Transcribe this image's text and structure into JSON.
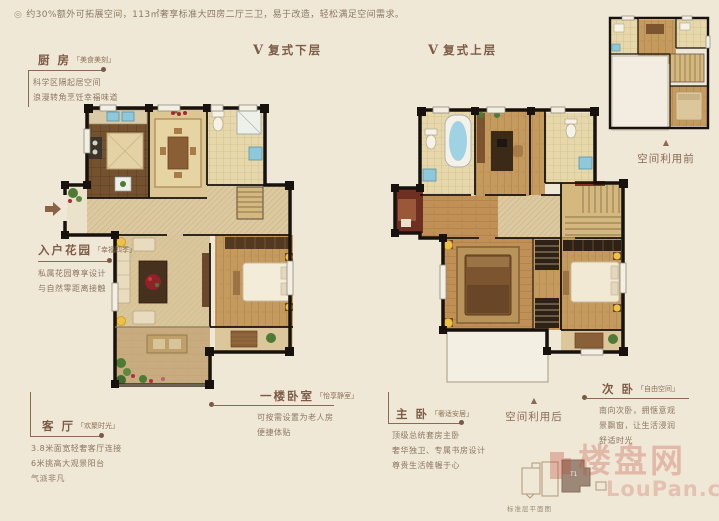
{
  "page": {
    "bullet": "◎",
    "header_note": "约30%额外可拓展空间，113㎡奢享标准大四房二厅三卫，易于改造，轻松满足空间需求。"
  },
  "sections": {
    "lower": {
      "marker": "V",
      "title": "复式下层"
    },
    "upper": {
      "marker": "V",
      "title": "复式上层"
    }
  },
  "callouts": {
    "kitchen": {
      "title": "厨 房",
      "tag": "「美食美刻」",
      "line1": "科学区隔起居空间",
      "line2": "浪漫转角烹饪幸福味道"
    },
    "entry_garden": {
      "title": "入户花园",
      "tag": "「幸福四季」",
      "line1": "私属花园尊享设计",
      "line2": "与自然零距离接触"
    },
    "living_room": {
      "title": "客 厅",
      "tag": "「欢聚时光」",
      "line1": "3.8米面宽轻奢客厅连接",
      "line2": "6米挑高大观景阳台",
      "line3": "气派非凡"
    },
    "first_floor_bedroom": {
      "title": "一楼卧室",
      "tag": "「怡享静室」",
      "line1": "可按需设置为老人房",
      "line2": "便捷体贴"
    },
    "master_bedroom": {
      "title": "主 卧",
      "tag": "「奢适安居」",
      "line1": "顶级总统套房主卧",
      "line2": "奢华独卫、专属书房设计",
      "line3": "尊贵生活帷幄于心"
    },
    "second_bedroom": {
      "title": "次 卧",
      "tag": "「自由空间」",
      "line1": "南向次卧，拥惬意观",
      "line2": "景飘窗，让生活浸润",
      "line3": "舒适时光"
    }
  },
  "markers": {
    "space_before": {
      "arrow": "▲",
      "label": "空间利用前"
    },
    "space_after": {
      "arrow": "▲",
      "label": "空间利用后"
    }
  },
  "keyplate": {
    "unit_label": "T1",
    "caption": "标准层平面图"
  },
  "watermark": {
    "cn": "楼盘网",
    "en": "LouPan.com"
  },
  "colors": {
    "background": "#efe8d7",
    "accent_brown": "#8a6a52",
    "wall_black": "#17120d",
    "floor_beige": "#dcc9a0",
    "wood": "#c59a5e",
    "watermark_red": "#c64e40"
  }
}
